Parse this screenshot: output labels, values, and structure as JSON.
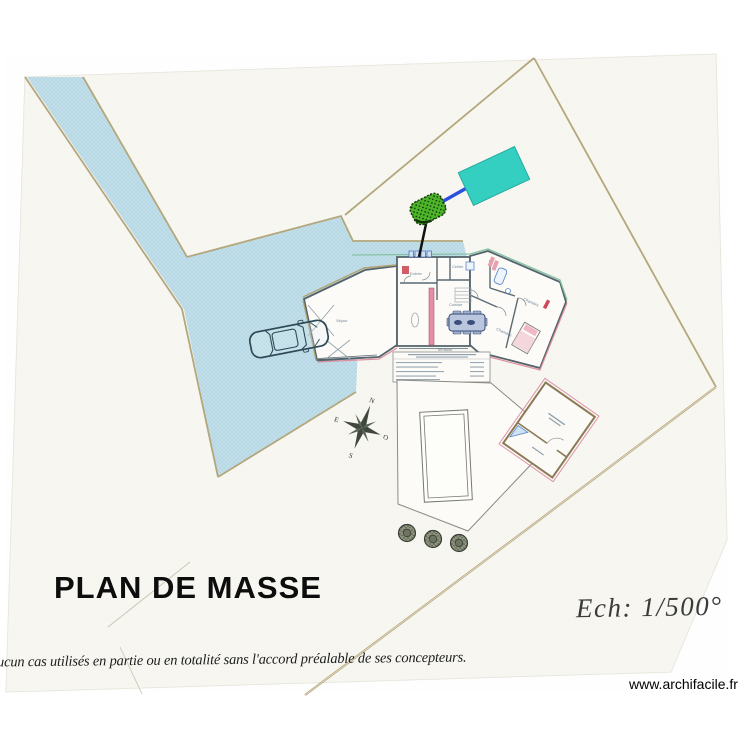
{
  "page": {
    "plan_title": "PLAN DE MASSE",
    "scale_label": "Ech: 1/500°",
    "footer_disclaimer": "ucun cas utilisés en partie ou en totalité sans l'accord préalable de ses concepteurs.",
    "watermark": "www.archifacile.fr"
  },
  "compass": {
    "n": "N",
    "s": "S",
    "e": "E",
    "o": "O"
  },
  "room_labels": {
    "living": "Séjour",
    "entry": "Entrée",
    "storage": "Cellier",
    "kitchen": "Cuisine",
    "bedroom1": "Chambre",
    "bedroom2": "Chambre",
    "terrace": "Terrasse"
  },
  "colors": {
    "driveway_fill": "#c3e0ea",
    "boundary_tan": "#b4a77c",
    "annotation_rect_fill": "#35cfc2",
    "annotation_line_blue": "#2b50e0",
    "shrub_green": "#4cb528",
    "wall_pink": "#e38fa5",
    "wall_teal": "#86c2a4"
  }
}
